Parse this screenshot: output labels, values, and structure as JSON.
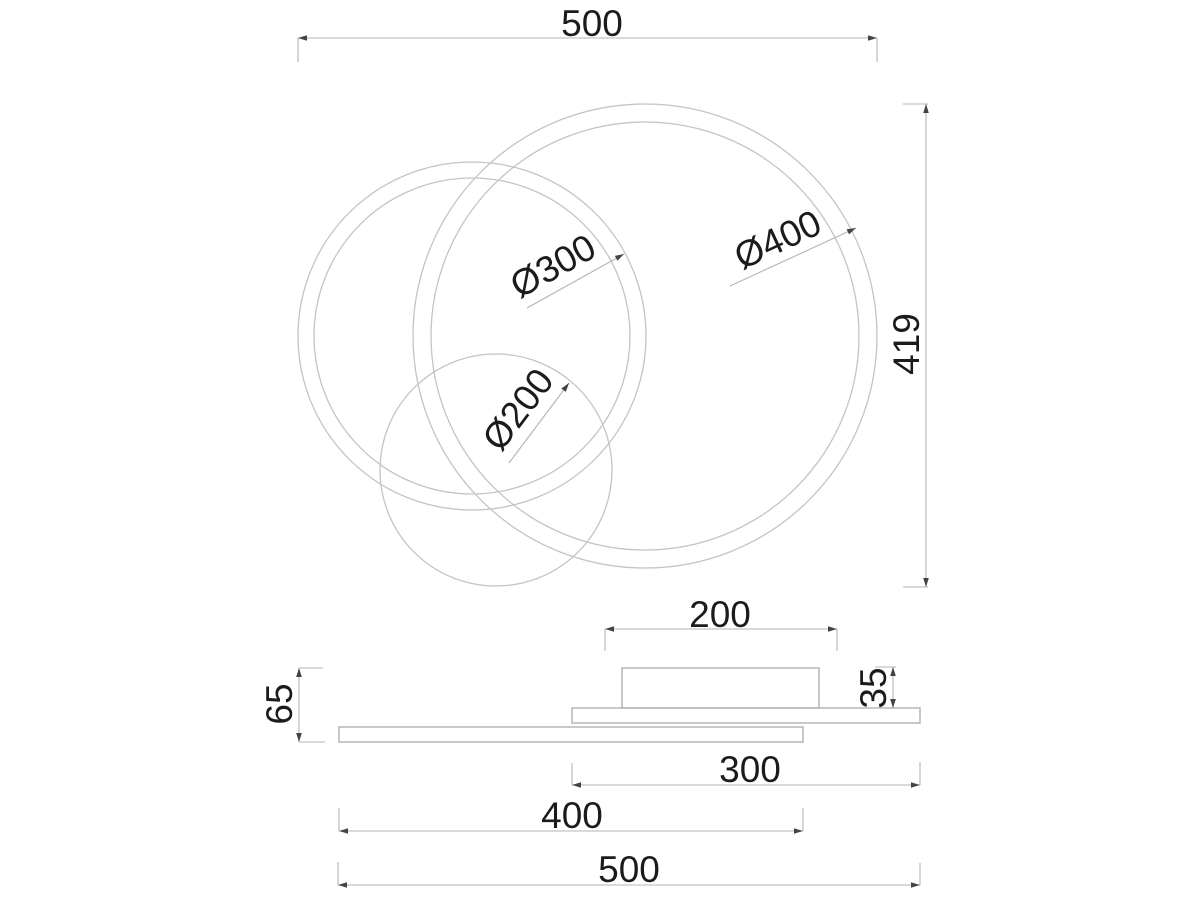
{
  "drawing_type": "dimension-drawing",
  "top_view": {
    "overall_width": "500",
    "overall_height": "419",
    "ring_large_label": "Ø400",
    "ring_medium_label": "Ø300",
    "ring_small_label": "Ø200"
  },
  "side_view": {
    "canopy_width": "200",
    "canopy_height": "35",
    "fixture_height": "65",
    "plate_medium_width": "300",
    "plate_large_width": "400",
    "overall_width": "500"
  },
  "colors": {
    "background": "#ffffff",
    "drawing_line": "#c4c4c4",
    "rectangle_line": "#ababab",
    "dimension_line": "#b4b4b4",
    "text": "#1b1b1b",
    "arrow": "#444444"
  }
}
